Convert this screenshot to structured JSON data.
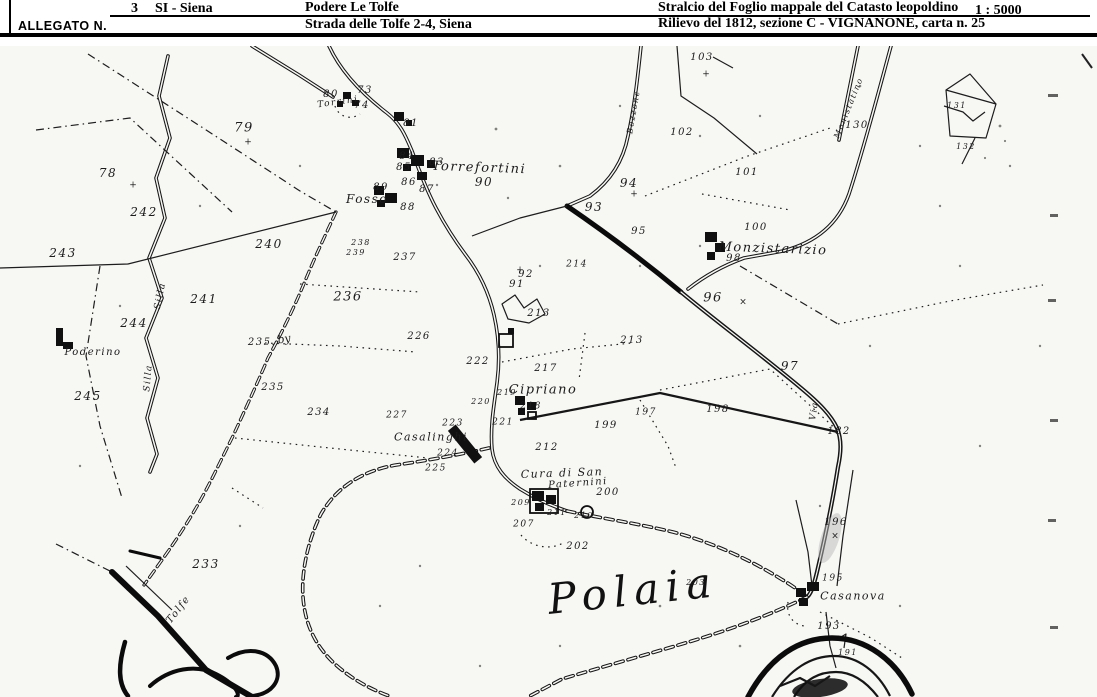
{
  "header": {
    "allegato_label": "ALLEGATO N.",
    "number": "3",
    "province": "SI - Siena",
    "farm_name": "Podere Le Tolfe",
    "farm_address": "Strada delle Tolfe 2-4, Siena",
    "map_title": "Stralcio del Foglio mappale del Catasto leopoldino",
    "map_subtitle": "Rilievo del 1812, sezione C - VIGNANONE, carta n. 25",
    "scale": "1 : 5000"
  },
  "map": {
    "place_labels": [
      {
        "t": "Torrini",
        "x": 338,
        "y": 57,
        "s": 9,
        "r": -8
      },
      {
        "t": "Torrefortini",
        "x": 479,
        "y": 122,
        "s": 13,
        "r": 2
      },
      {
        "t": "Fosso",
        "x": 367,
        "y": 153,
        "s": 12,
        "r": 0
      },
      {
        "t": "Poderino",
        "x": 93,
        "y": 307,
        "s": 10,
        "r": 0
      },
      {
        "t": "Cipriano",
        "x": 543,
        "y": 344,
        "s": 13,
        "r": 0
      },
      {
        "t": "Casalinghi",
        "x": 431,
        "y": 391,
        "s": 11,
        "r": 0
      },
      {
        "t": "Cura di San",
        "x": 562,
        "y": 427,
        "s": 11,
        "r": -2
      },
      {
        "t": "Paternini",
        "x": 578,
        "y": 438,
        "s": 10,
        "r": -4
      },
      {
        "t": "Monzistarizio",
        "x": 773,
        "y": 203,
        "s": 13,
        "r": 2
      },
      {
        "t": "Casanova",
        "x": 853,
        "y": 550,
        "s": 11,
        "r": 0
      },
      {
        "t": "Polaia",
        "x": 633,
        "y": 545,
        "s": 42,
        "r": -6,
        "big": true
      },
      {
        "t": "Silla",
        "x": 161,
        "y": 250,
        "s": 9,
        "r": -78
      },
      {
        "t": "Silla",
        "x": 149,
        "y": 332,
        "s": 9,
        "r": -85
      },
      {
        "t": "Tolfe",
        "x": 179,
        "y": 564,
        "s": 10,
        "r": -52
      },
      {
        "t": "Bozzone",
        "x": 634,
        "y": 66,
        "s": 8,
        "r": -80
      },
      {
        "t": "Via",
        "x": 815,
        "y": 365,
        "s": 9,
        "r": -82
      },
      {
        "t": "Monistatino",
        "x": 849,
        "y": 62,
        "s": 8,
        "r": -68
      }
    ],
    "parcel_numbers": [
      {
        "t": "73",
        "x": 365,
        "y": 45
      },
      {
        "t": "74",
        "x": 362,
        "y": 60
      },
      {
        "t": "80",
        "x": 331,
        "y": 49
      },
      {
        "t": "81",
        "x": 411,
        "y": 78
      },
      {
        "t": "83",
        "x": 437,
        "y": 117
      },
      {
        "t": "84",
        "x": 407,
        "y": 111
      },
      {
        "t": "85",
        "x": 404,
        "y": 122
      },
      {
        "t": "86",
        "x": 409,
        "y": 137
      },
      {
        "t": "87",
        "x": 427,
        "y": 144
      },
      {
        "t": "88",
        "x": 408,
        "y": 162
      },
      {
        "t": "89",
        "x": 381,
        "y": 142
      },
      {
        "t": "90",
        "x": 484,
        "y": 136,
        "s": 12
      },
      {
        "t": "91",
        "x": 517,
        "y": 239
      },
      {
        "t": "92",
        "x": 526,
        "y": 229
      },
      {
        "t": "93",
        "x": 594,
        "y": 161,
        "s": 12
      },
      {
        "t": "94",
        "x": 629,
        "y": 137,
        "s": 12
      },
      {
        "t": "95",
        "x": 639,
        "y": 186
      },
      {
        "t": "96",
        "x": 713,
        "y": 252,
        "s": 13
      },
      {
        "t": "97",
        "x": 790,
        "y": 320,
        "s": 12
      },
      {
        "t": "98",
        "x": 734,
        "y": 213
      },
      {
        "t": "100",
        "x": 756,
        "y": 182
      },
      {
        "t": "101",
        "x": 747,
        "y": 127
      },
      {
        "t": "102",
        "x": 682,
        "y": 87
      },
      {
        "t": "103",
        "x": 702,
        "y": 12
      },
      {
        "t": "130",
        "x": 857,
        "y": 80
      },
      {
        "t": "131",
        "x": 957,
        "y": 60,
        "s": 8
      },
      {
        "t": "132",
        "x": 966,
        "y": 101,
        "s": 8
      },
      {
        "t": "182",
        "x": 839,
        "y": 386
      },
      {
        "t": "191",
        "x": 848,
        "y": 607,
        "s": 8
      },
      {
        "t": "193",
        "x": 829,
        "y": 581
      },
      {
        "t": "195",
        "x": 833,
        "y": 533,
        "s": 9
      },
      {
        "t": "196",
        "x": 836,
        "y": 477
      },
      {
        "t": "197",
        "x": 646,
        "y": 367,
        "s": 9
      },
      {
        "t": "198",
        "x": 718,
        "y": 364
      },
      {
        "t": "199",
        "x": 606,
        "y": 380
      },
      {
        "t": "200",
        "x": 608,
        "y": 447
      },
      {
        "t": "202",
        "x": 578,
        "y": 501
      },
      {
        "t": "203",
        "x": 696,
        "y": 537,
        "s": 8
      },
      {
        "t": "207",
        "x": 524,
        "y": 479,
        "s": 9
      },
      {
        "t": "209",
        "x": 521,
        "y": 457,
        "s": 8
      },
      {
        "t": "210",
        "x": 584,
        "y": 470,
        "s": 8
      },
      {
        "t": "211",
        "x": 557,
        "y": 467,
        "s": 8
      },
      {
        "t": "212",
        "x": 547,
        "y": 402
      },
      {
        "t": "213",
        "x": 539,
        "y": 268
      },
      {
        "t": "213",
        "x": 632,
        "y": 295
      },
      {
        "t": "214",
        "x": 577,
        "y": 219,
        "s": 9
      },
      {
        "t": "217",
        "x": 546,
        "y": 323
      },
      {
        "t": "218",
        "x": 531,
        "y": 361,
        "s": 9
      },
      {
        "t": "219",
        "x": 507,
        "y": 347,
        "s": 8
      },
      {
        "t": "220",
        "x": 481,
        "y": 356,
        "s": 8
      },
      {
        "t": "221",
        "x": 503,
        "y": 377,
        "s": 9
      },
      {
        "t": "222",
        "x": 478,
        "y": 316
      },
      {
        "t": "223",
        "x": 453,
        "y": 378,
        "s": 9
      },
      {
        "t": "224",
        "x": 448,
        "y": 408,
        "s": 9
      },
      {
        "t": "225",
        "x": 436,
        "y": 423,
        "s": 9
      },
      {
        "t": "226",
        "x": 419,
        "y": 291
      },
      {
        "t": "227",
        "x": 397,
        "y": 370,
        "s": 9
      },
      {
        "t": "233",
        "x": 206,
        "y": 518,
        "s": 12
      },
      {
        "t": "234",
        "x": 319,
        "y": 367
      },
      {
        "t": "235",
        "x": 273,
        "y": 342
      },
      {
        "t": "235.",
        "x": 262,
        "y": 297
      },
      {
        "t": "236",
        "x": 348,
        "y": 251,
        "s": 13
      },
      {
        "t": "237",
        "x": 405,
        "y": 212
      },
      {
        "t": "238",
        "x": 361,
        "y": 197,
        "s": 8
      },
      {
        "t": "239",
        "x": 356,
        "y": 207,
        "s": 8
      },
      {
        "t": "240",
        "x": 269,
        "y": 198,
        "s": 12
      },
      {
        "t": "241",
        "x": 204,
        "y": 253,
        "s": 12
      },
      {
        "t": "242",
        "x": 144,
        "y": 166,
        "s": 12
      },
      {
        "t": "243",
        "x": 63,
        "y": 207,
        "s": 12
      },
      {
        "t": "244",
        "x": 134,
        "y": 277,
        "s": 12
      },
      {
        "t": "245",
        "x": 88,
        "y": 350,
        "s": 12
      },
      {
        "t": "78",
        "x": 108,
        "y": 127,
        "s": 12
      },
      {
        "t": "79",
        "x": 244,
        "y": 82,
        "s": 13
      }
    ],
    "symbols": [
      {
        "t": "+",
        "x": 248,
        "y": 97
      },
      {
        "t": "+",
        "x": 133,
        "y": 140
      },
      {
        "t": "×",
        "x": 743,
        "y": 257
      },
      {
        "t": "×",
        "x": 835,
        "y": 491
      },
      {
        "t": "+",
        "x": 706,
        "y": 29
      },
      {
        "t": "+",
        "x": 520,
        "y": 225
      },
      {
        "t": "+",
        "x": 634,
        "y": 149
      },
      {
        "t": "by",
        "x": 284,
        "y": 293,
        "s": 11,
        "r": -10
      }
    ]
  }
}
